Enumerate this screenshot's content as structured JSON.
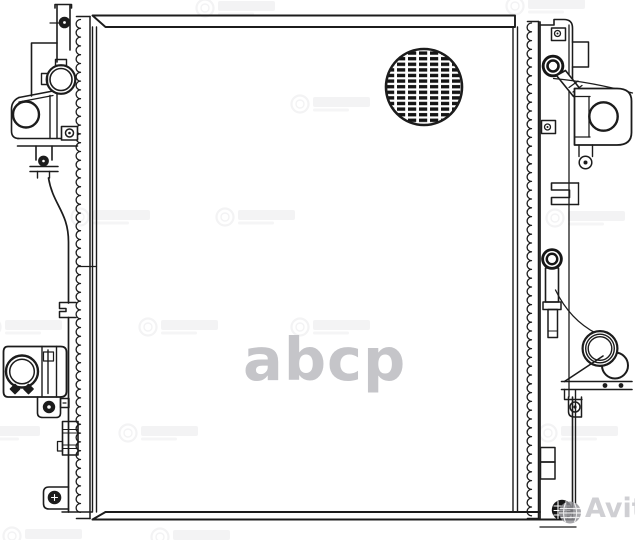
{
  "page": {
    "background_color": "#ffffff",
    "description": "Black-and-white technical line drawing of an automotive radiator (front schematic view) used as a marketplace listing image"
  },
  "drawing": {
    "ink_color": "#1c1c1c",
    "parts": [
      "top-mounting-band",
      "radiator-core",
      "left-serrated-seam",
      "right-serrated-seam",
      "core-fin-detail-circle",
      "upper-left-inlet-port",
      "upper-left-bracket",
      "left-drain-fitting",
      "left-tank-outline",
      "lower-left-outlet-port",
      "lower-left-mounting-tab",
      "lower-left-block",
      "lower-left-screw-tab",
      "right-tank",
      "filler-cap-with-neck",
      "upper-right-port-bracket",
      "right-clevis-bracket",
      "right-drain-plug",
      "lower-right-outlet-pipe",
      "gusset-bracket",
      "bottom-drain-plug",
      "side-slots"
    ]
  },
  "watermarks": {
    "center": {
      "text": "abcp",
      "color": "#c5c5c9"
    },
    "marketplace": {
      "text": "Avito",
      "color": "#c1c1c7",
      "logo": "avito-globe-icon"
    },
    "brand_stamp": {
      "icon": "circular-brand-stamp-icon",
      "color": "#bcbcc2",
      "count": 14
    }
  }
}
